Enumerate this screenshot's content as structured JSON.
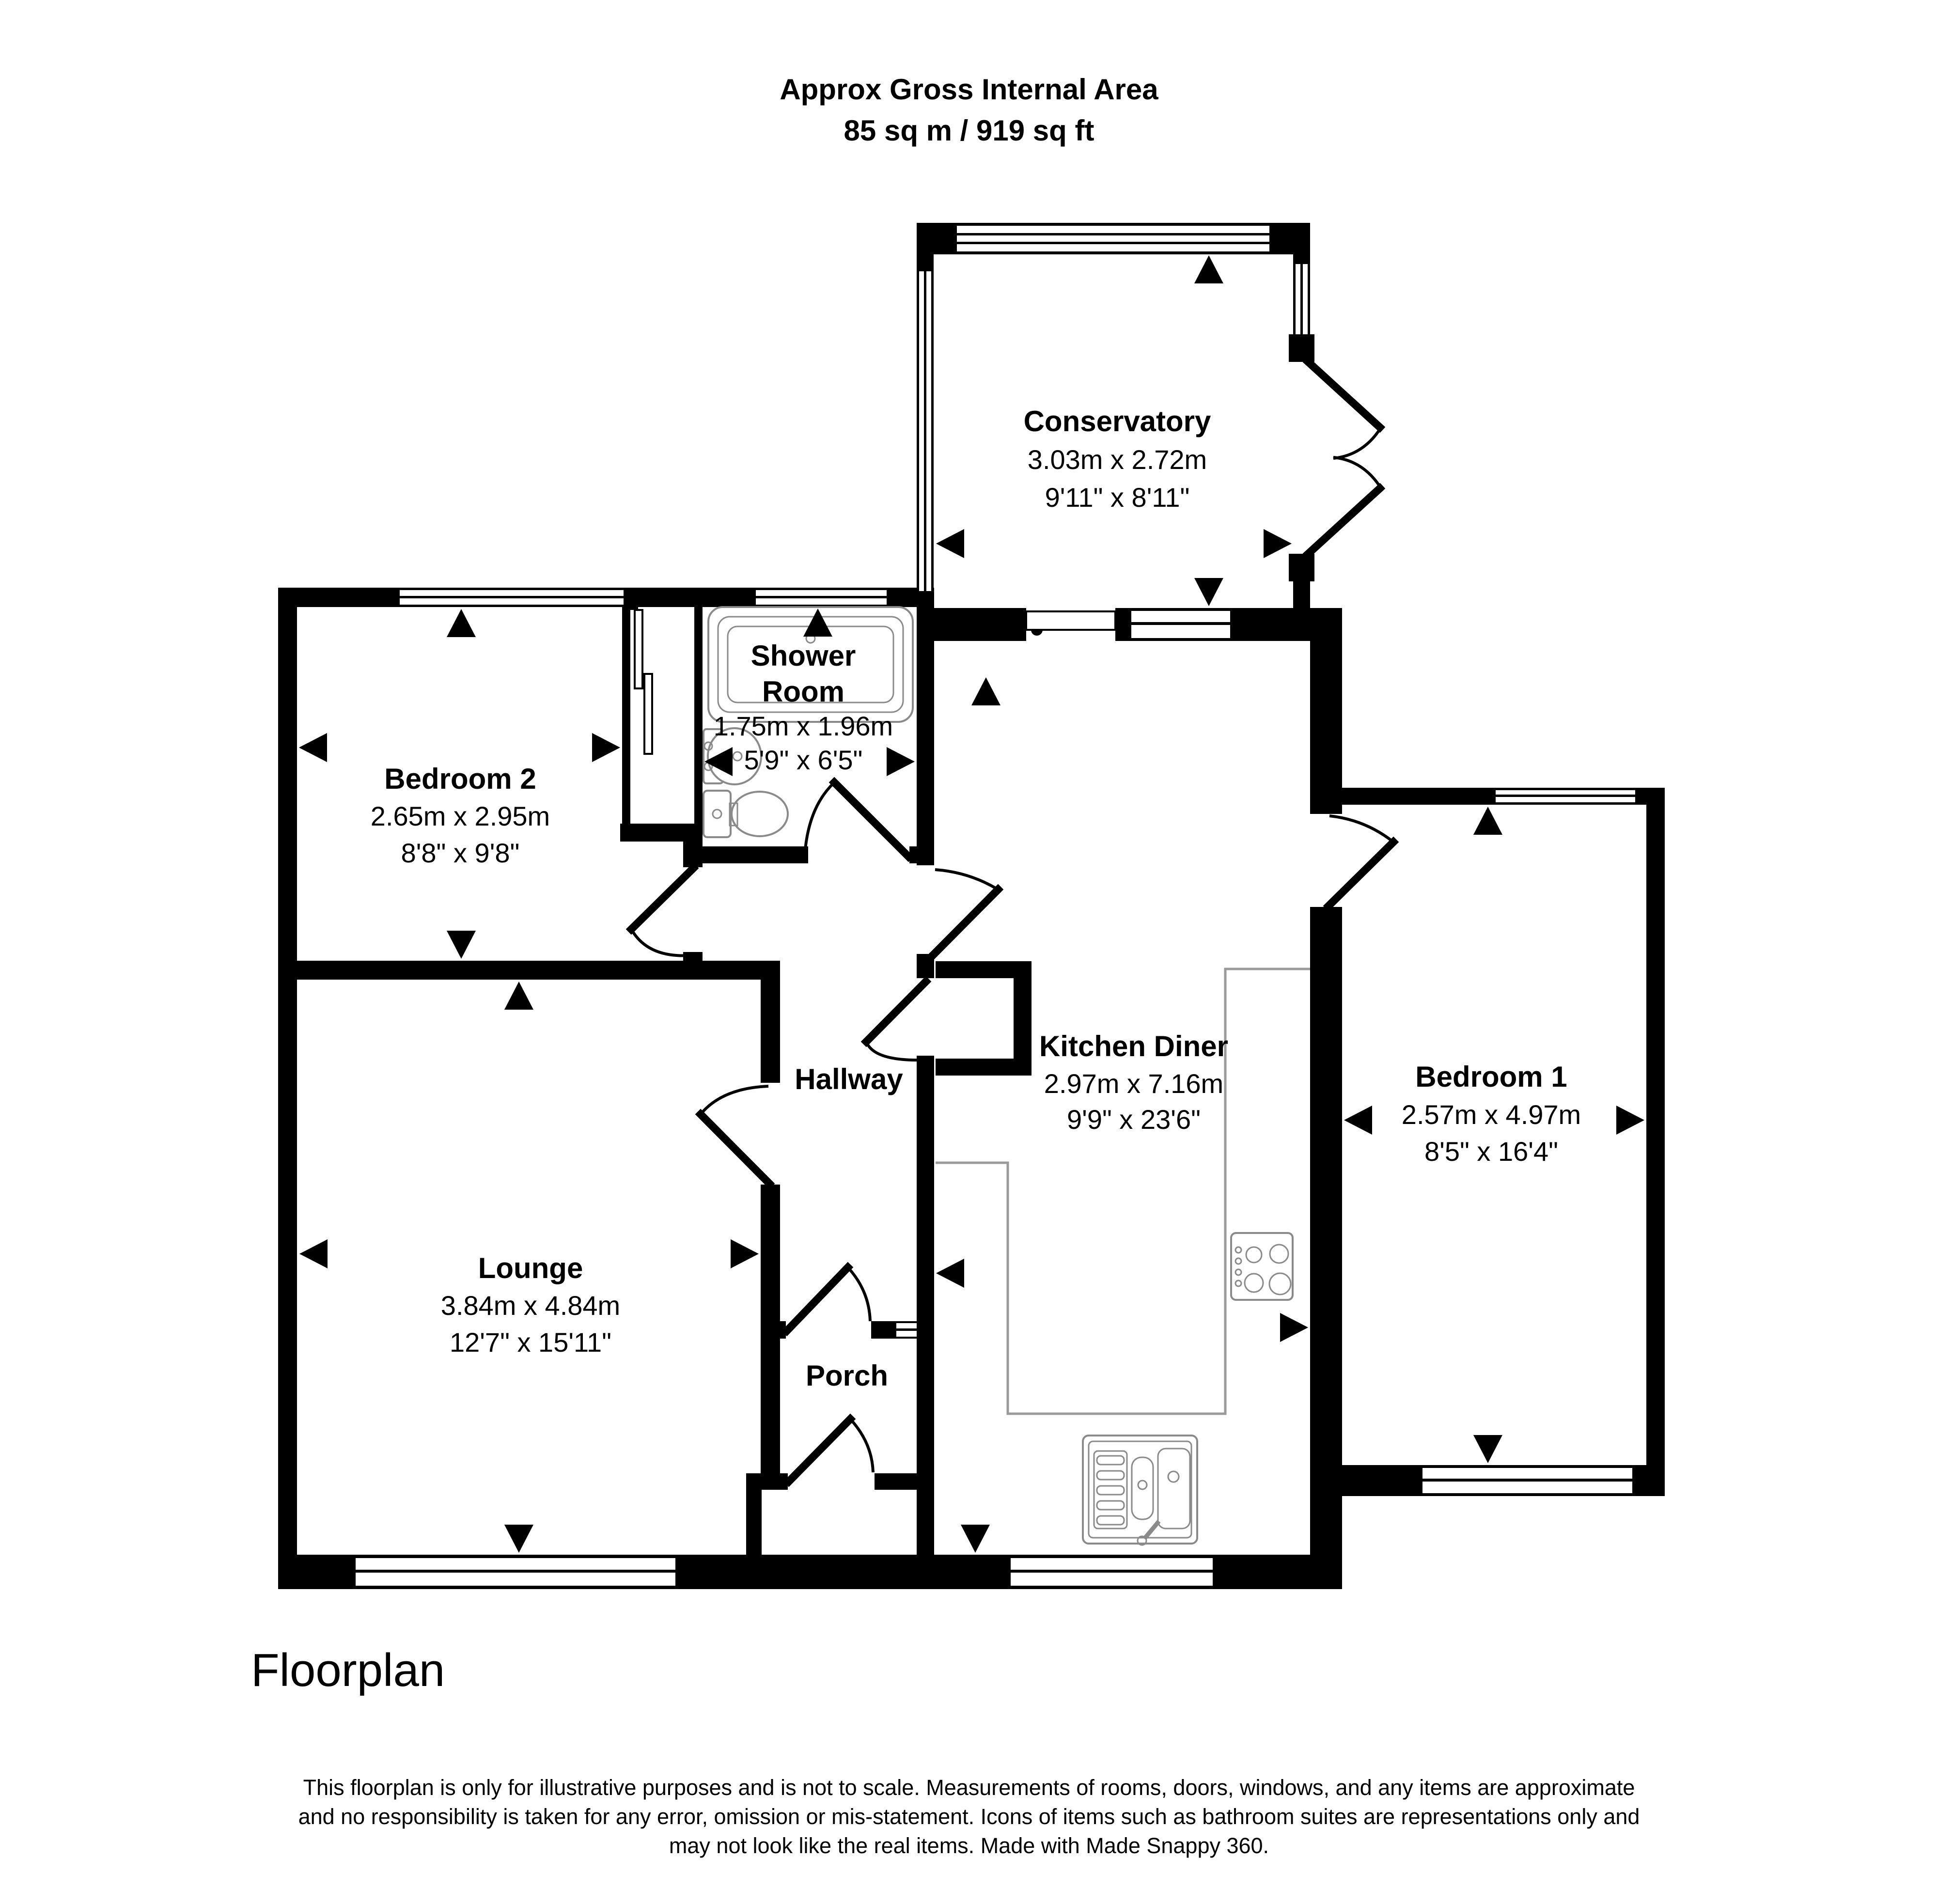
{
  "header": {
    "line1": "Approx Gross Internal Area",
    "line2": "85 sq m / 919 sq ft"
  },
  "rooms": {
    "conservatory": {
      "name": "Conservatory",
      "metric": "3.03m x 2.72m",
      "imperial": "9'11\" x 8'11\""
    },
    "bedroom2": {
      "name": "Bedroom 2",
      "metric": "2.65m x 2.95m",
      "imperial": "8'8\" x 9'8\""
    },
    "shower": {
      "name_line1": "Shower",
      "name_line2": "Room",
      "metric": "1.75m x 1.96m",
      "imperial": "5'9\" x 6'5\""
    },
    "kitchen": {
      "name": "Kitchen Diner",
      "metric": "2.97m x 7.16m",
      "imperial": "9'9\" x 23'6\""
    },
    "bedroom1": {
      "name": "Bedroom 1",
      "metric": "2.57m x 4.97m",
      "imperial": "8'5\" x 16'4\""
    },
    "lounge": {
      "name": "Lounge",
      "metric": "3.84m x 4.84m",
      "imperial": "12'7\" x 15'11\""
    },
    "hallway": {
      "name": "Hallway"
    },
    "porch": {
      "name": "Porch"
    }
  },
  "footer": {
    "plan_label": "Floorplan"
  },
  "disclaimer": {
    "line1": "This floorplan is only for illustrative purposes and is not to scale. Measurements of rooms, doors, windows, and any items are approximate",
    "line2": "and no responsibility is taken for any error, omission or mis-statement. Icons of items such as bathroom suites are representations only and",
    "line3": "may not look like the real items. Made with Made Snappy 360."
  },
  "icons": {
    "bath": "bath-icon",
    "basin": "basin-icon",
    "toilet": "toilet-icon",
    "hob": "hob-icon",
    "sink": "sink-icon",
    "window": "window-symbol",
    "door": "door-swing-symbol",
    "sliding_door": "sliding-door-symbol",
    "measure_arrow": "measure-arrow"
  },
  "colors": {
    "walls": "#000000",
    "fixtures": "#8a8a8a",
    "background": "#ffffff"
  }
}
